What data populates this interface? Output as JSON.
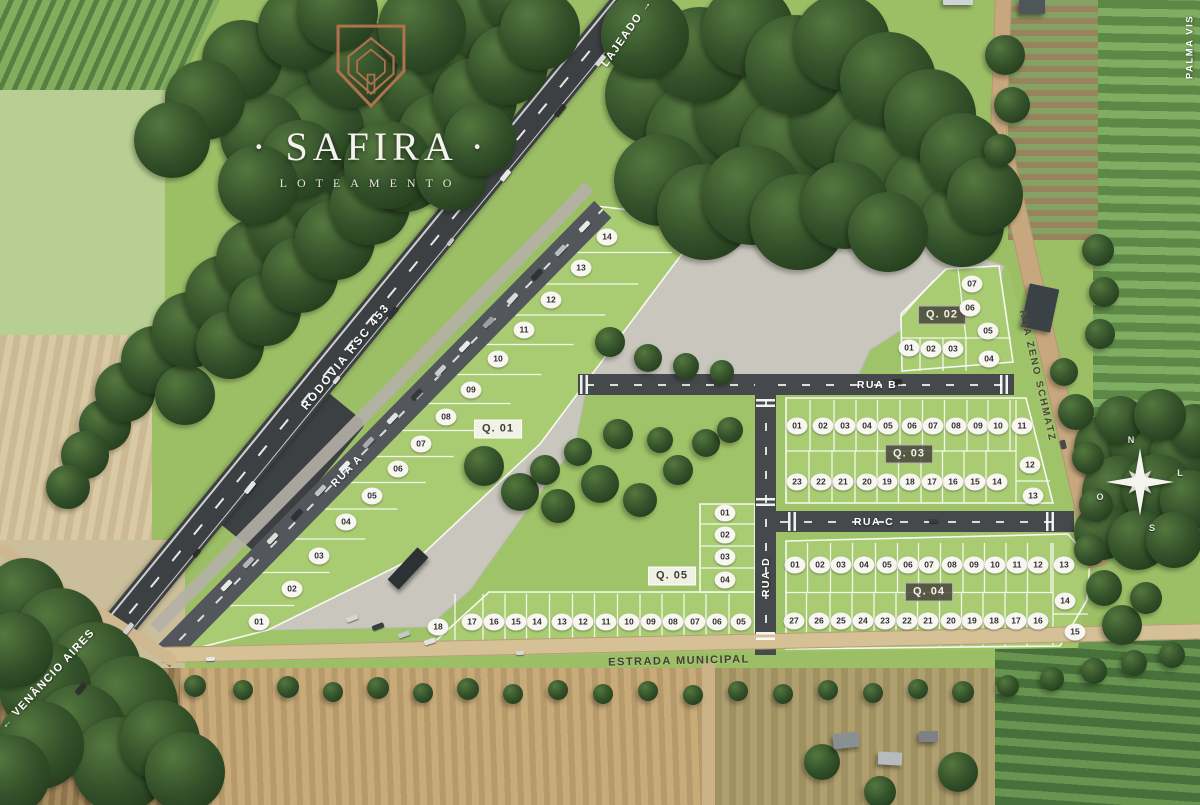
{
  "brand": {
    "title": "SAFIRA",
    "title_decorated": "· SAFIRA ·",
    "subtitle": "LOTEAMENTO"
  },
  "labels": {
    "highway": "RODOVIA RSC 453",
    "direction_northeast": "LAJEADO →",
    "direction_southwest": "← VENÂNCIO AIRES",
    "rua_a": "RUA A",
    "rua_b": "RUA B",
    "rua_c": "RUA C",
    "rua_d": "RUA D",
    "rua_zeno": "RUA ZENO SCHMATZ",
    "estrada": "ESTRADA MUNICIPAL",
    "edge_right": "PALMA VIS"
  },
  "compass": {
    "north": "N",
    "east": "L",
    "south": "S",
    "west": "O"
  },
  "colors": {
    "brand_copper": "#b0714d",
    "chip_bg": "#f7f6f0",
    "chip_text": "#2f2f2f",
    "grass": "#a9cc72",
    "gravel": "#c9c6bd",
    "asphalt": "#46494b",
    "dirt_road": "#c7a87e"
  },
  "quadras": [
    {
      "name": "Q. 01",
      "badge": {
        "x": 498,
        "y": 429,
        "style": "light"
      },
      "lots": [
        {
          "n": "01",
          "x": 259,
          "y": 622
        },
        {
          "n": "02",
          "x": 292,
          "y": 589
        },
        {
          "n": "03",
          "x": 319,
          "y": 556
        },
        {
          "n": "04",
          "x": 346,
          "y": 522
        },
        {
          "n": "05",
          "x": 372,
          "y": 496
        },
        {
          "n": "06",
          "x": 398,
          "y": 469
        },
        {
          "n": "07",
          "x": 421,
          "y": 444
        },
        {
          "n": "08",
          "x": 446,
          "y": 417
        },
        {
          "n": "09",
          "x": 471,
          "y": 390
        },
        {
          "n": "10",
          "x": 498,
          "y": 359
        },
        {
          "n": "11",
          "x": 524,
          "y": 330
        },
        {
          "n": "12",
          "x": 551,
          "y": 300
        },
        {
          "n": "13",
          "x": 581,
          "y": 268
        },
        {
          "n": "14",
          "x": 607,
          "y": 237
        }
      ]
    },
    {
      "name": "Q. 02",
      "badge": {
        "x": 942,
        "y": 315,
        "style": "dark"
      },
      "lots": [
        {
          "n": "01",
          "x": 909,
          "y": 348
        },
        {
          "n": "02",
          "x": 931,
          "y": 349
        },
        {
          "n": "03",
          "x": 953,
          "y": 349
        },
        {
          "n": "04",
          "x": 989,
          "y": 359
        },
        {
          "n": "05",
          "x": 988,
          "y": 331
        },
        {
          "n": "06",
          "x": 970,
          "y": 308
        },
        {
          "n": "07",
          "x": 972,
          "y": 284
        }
      ]
    },
    {
      "name": "Q. 03",
      "badge": {
        "x": 909,
        "y": 454,
        "style": "dark"
      },
      "lots": [
        {
          "n": "01",
          "x": 797,
          "y": 426
        },
        {
          "n": "02",
          "x": 823,
          "y": 426
        },
        {
          "n": "03",
          "x": 845,
          "y": 426
        },
        {
          "n": "04",
          "x": 867,
          "y": 426
        },
        {
          "n": "05",
          "x": 888,
          "y": 426
        },
        {
          "n": "06",
          "x": 912,
          "y": 426
        },
        {
          "n": "07",
          "x": 933,
          "y": 426
        },
        {
          "n": "08",
          "x": 956,
          "y": 426
        },
        {
          "n": "09",
          "x": 978,
          "y": 426
        },
        {
          "n": "10",
          "x": 998,
          "y": 426
        },
        {
          "n": "11",
          "x": 1022,
          "y": 426
        },
        {
          "n": "12",
          "x": 1030,
          "y": 465
        },
        {
          "n": "13",
          "x": 1033,
          "y": 496
        },
        {
          "n": "14",
          "x": 997,
          "y": 482
        },
        {
          "n": "15",
          "x": 975,
          "y": 482
        },
        {
          "n": "16",
          "x": 953,
          "y": 482
        },
        {
          "n": "17",
          "x": 932,
          "y": 482
        },
        {
          "n": "18",
          "x": 910,
          "y": 482
        },
        {
          "n": "19",
          "x": 887,
          "y": 482
        },
        {
          "n": "20",
          "x": 867,
          "y": 482
        },
        {
          "n": "21",
          "x": 843,
          "y": 482
        },
        {
          "n": "22",
          "x": 821,
          "y": 482
        },
        {
          "n": "23",
          "x": 797,
          "y": 482
        }
      ]
    },
    {
      "name": "Q. 04",
      "badge": {
        "x": 929,
        "y": 592,
        "style": "dark"
      },
      "lots": [
        {
          "n": "01",
          "x": 795,
          "y": 565
        },
        {
          "n": "02",
          "x": 820,
          "y": 565
        },
        {
          "n": "03",
          "x": 841,
          "y": 565
        },
        {
          "n": "04",
          "x": 864,
          "y": 565
        },
        {
          "n": "05",
          "x": 887,
          "y": 565
        },
        {
          "n": "06",
          "x": 908,
          "y": 565
        },
        {
          "n": "07",
          "x": 929,
          "y": 565
        },
        {
          "n": "08",
          "x": 952,
          "y": 565
        },
        {
          "n": "09",
          "x": 974,
          "y": 565
        },
        {
          "n": "10",
          "x": 995,
          "y": 565
        },
        {
          "n": "11",
          "x": 1017,
          "y": 565
        },
        {
          "n": "12",
          "x": 1038,
          "y": 565
        },
        {
          "n": "13",
          "x": 1064,
          "y": 565
        },
        {
          "n": "14",
          "x": 1065,
          "y": 601
        },
        {
          "n": "15",
          "x": 1075,
          "y": 632
        },
        {
          "n": "16",
          "x": 1038,
          "y": 621
        },
        {
          "n": "17",
          "x": 1016,
          "y": 621
        },
        {
          "n": "18",
          "x": 994,
          "y": 621
        },
        {
          "n": "19",
          "x": 972,
          "y": 621
        },
        {
          "n": "20",
          "x": 951,
          "y": 621
        },
        {
          "n": "21",
          "x": 928,
          "y": 621
        },
        {
          "n": "22",
          "x": 907,
          "y": 621
        },
        {
          "n": "23",
          "x": 885,
          "y": 621
        },
        {
          "n": "24",
          "x": 863,
          "y": 621
        },
        {
          "n": "25",
          "x": 841,
          "y": 621
        },
        {
          "n": "26",
          "x": 819,
          "y": 621
        },
        {
          "n": "27",
          "x": 794,
          "y": 621
        }
      ]
    },
    {
      "name": "Q. 05",
      "badge": {
        "x": 672,
        "y": 576,
        "style": "light"
      },
      "lots": [
        {
          "n": "01",
          "x": 725,
          "y": 513
        },
        {
          "n": "02",
          "x": 725,
          "y": 535
        },
        {
          "n": "03",
          "x": 725,
          "y": 557
        },
        {
          "n": "04",
          "x": 725,
          "y": 580
        },
        {
          "n": "05",
          "x": 741,
          "y": 622
        },
        {
          "n": "06",
          "x": 717,
          "y": 622
        },
        {
          "n": "07",
          "x": 695,
          "y": 622
        },
        {
          "n": "08",
          "x": 673,
          "y": 622
        },
        {
          "n": "09",
          "x": 651,
          "y": 622
        },
        {
          "n": "10",
          "x": 629,
          "y": 622
        },
        {
          "n": "11",
          "x": 606,
          "y": 622
        },
        {
          "n": "12",
          "x": 583,
          "y": 622
        },
        {
          "n": "13",
          "x": 562,
          "y": 622
        },
        {
          "n": "14",
          "x": 537,
          "y": 622
        },
        {
          "n": "15",
          "x": 516,
          "y": 622
        },
        {
          "n": "16",
          "x": 494,
          "y": 622
        },
        {
          "n": "17",
          "x": 472,
          "y": 622
        },
        {
          "n": "18",
          "x": 438,
          "y": 627
        }
      ]
    }
  ]
}
